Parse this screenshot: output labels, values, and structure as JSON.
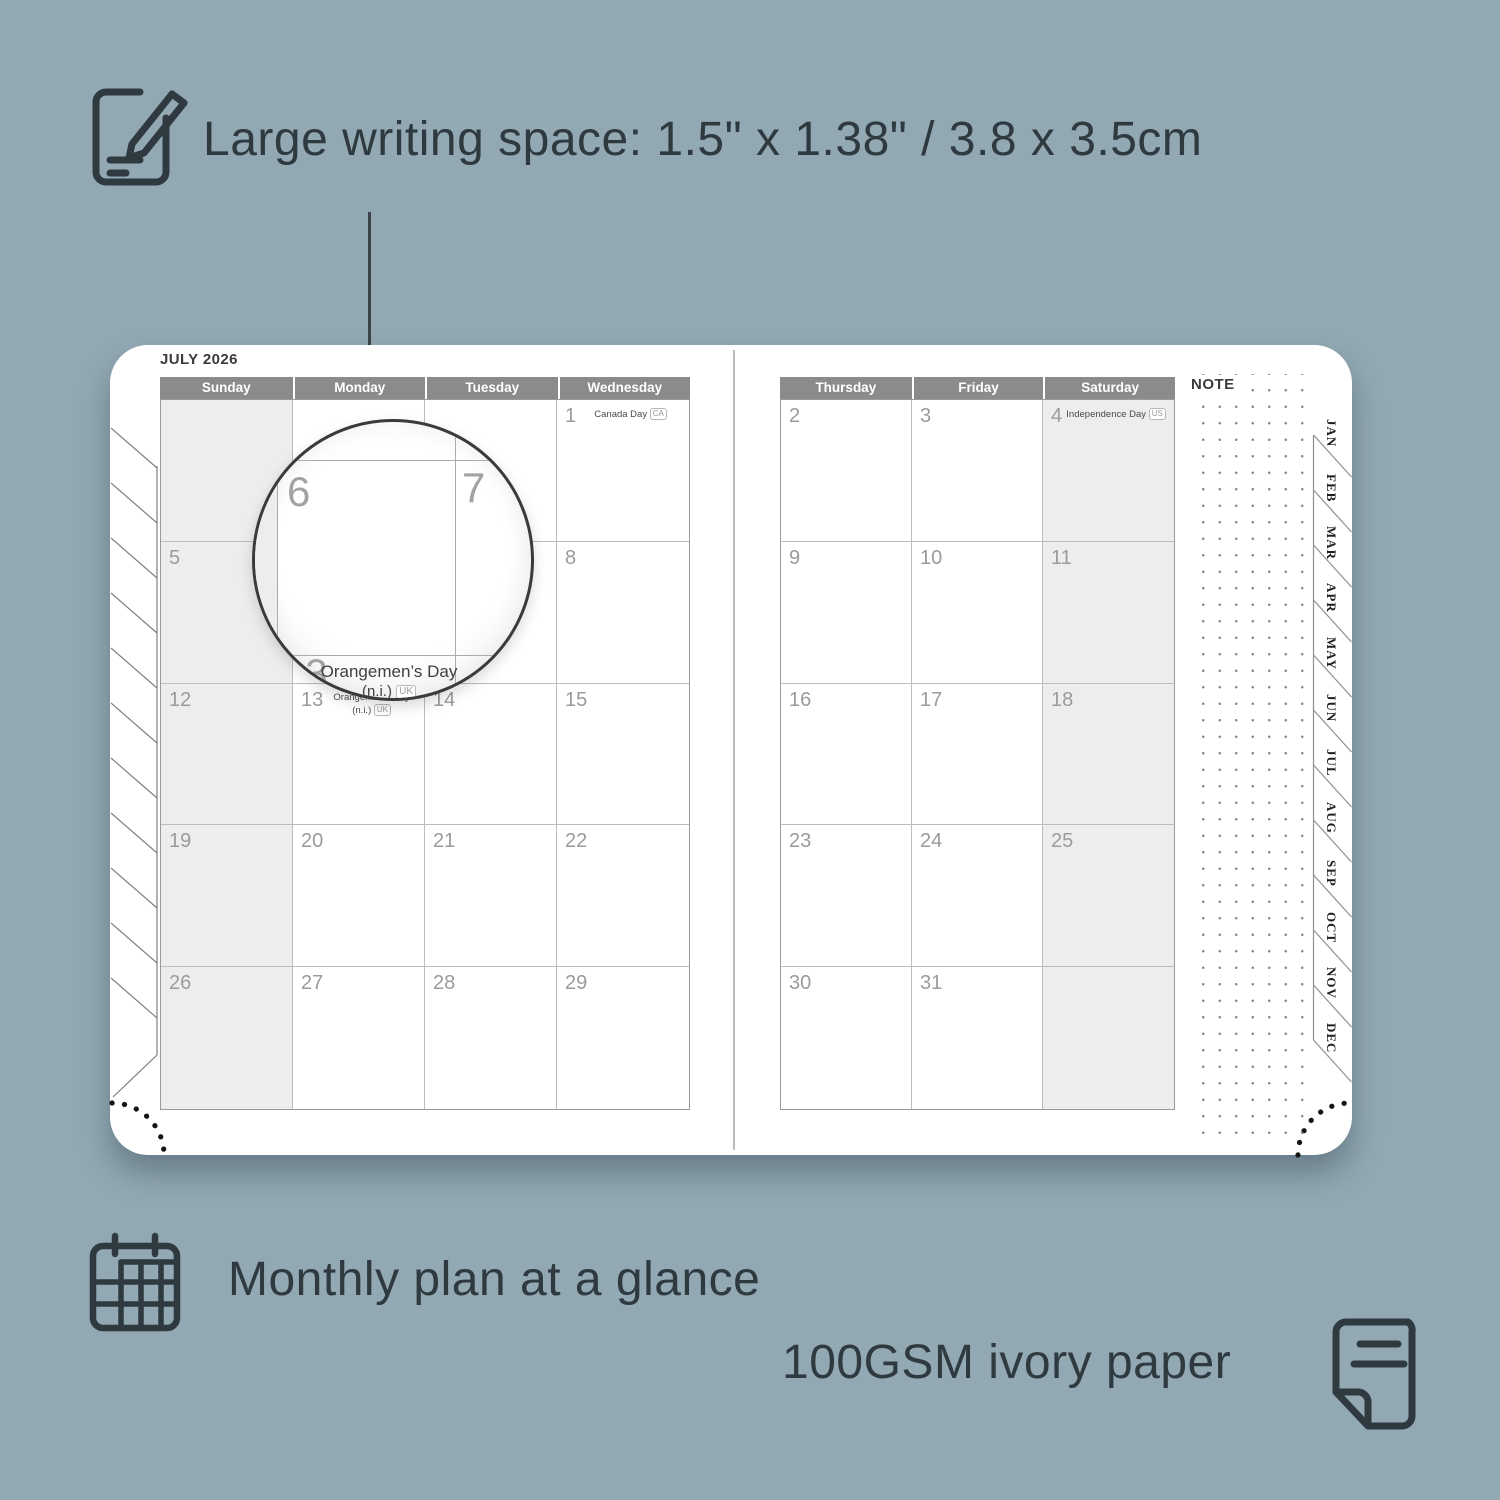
{
  "annotations": {
    "top": {
      "text": "Large writing space: 1.5\" x 1.38\" / 3.8 x 3.5cm"
    },
    "monthly": {
      "text": "Monthly plan at a glance"
    },
    "paper": {
      "text": "100GSM ivory paper"
    }
  },
  "colors": {
    "background": "#92a8b3",
    "annotation_text": "#2e3a40",
    "day_header_bar": "#8b8b8b",
    "shaded_column": "#ededed",
    "date_number": "#9b9b9b",
    "page": "#ffffff"
  },
  "planner": {
    "title": "JULY 2026",
    "note_label": "NOTE",
    "left_page": {
      "day_headers": [
        "Sunday",
        "Monday",
        "Tuesday",
        "Wednesday"
      ],
      "rows": [
        [
          {},
          {},
          {},
          {
            "d": "1",
            "h1": "Canada Day",
            "badge": "CA"
          }
        ],
        [
          {
            "d": "5"
          },
          {
            "d": "6"
          },
          {
            "d": "7"
          },
          {
            "d": "8"
          }
        ],
        [
          {
            "d": "12"
          },
          {
            "d": "13",
            "h1": "Orangemen’s Day",
            "h2": "(n.i.)",
            "badge": "UK"
          },
          {
            "d": "14"
          },
          {
            "d": "15"
          }
        ],
        [
          {
            "d": "19"
          },
          {
            "d": "20"
          },
          {
            "d": "21"
          },
          {
            "d": "22"
          }
        ],
        [
          {
            "d": "26"
          },
          {
            "d": "27"
          },
          {
            "d": "28"
          },
          {
            "d": "29"
          }
        ]
      ]
    },
    "right_page": {
      "day_headers": [
        "Thursday",
        "Friday",
        "Saturday"
      ],
      "rows": [
        [
          {
            "d": "2"
          },
          {
            "d": "3"
          },
          {
            "d": "4",
            "h1": "Independence Day",
            "badge": "US"
          }
        ],
        [
          {
            "d": "9"
          },
          {
            "d": "10"
          },
          {
            "d": "11"
          }
        ],
        [
          {
            "d": "16"
          },
          {
            "d": "17"
          },
          {
            "d": "18"
          }
        ],
        [
          {
            "d": "23"
          },
          {
            "d": "24"
          },
          {
            "d": "25"
          }
        ],
        [
          {
            "d": "30"
          },
          {
            "d": "31"
          },
          {}
        ]
      ]
    },
    "tabs": [
      "JAN",
      "FEB",
      "MAR",
      "APR",
      "MAY",
      "JUN",
      "JUL",
      "AUG",
      "SEP",
      "OCT",
      "NOV",
      "DEC"
    ],
    "magnifier": {
      "day_a": "6",
      "day_b": "7",
      "day_c": "13",
      "holiday_line1": "Orangemen’s Day",
      "holiday_line2": "(n.i.)",
      "badge": "UK"
    }
  }
}
